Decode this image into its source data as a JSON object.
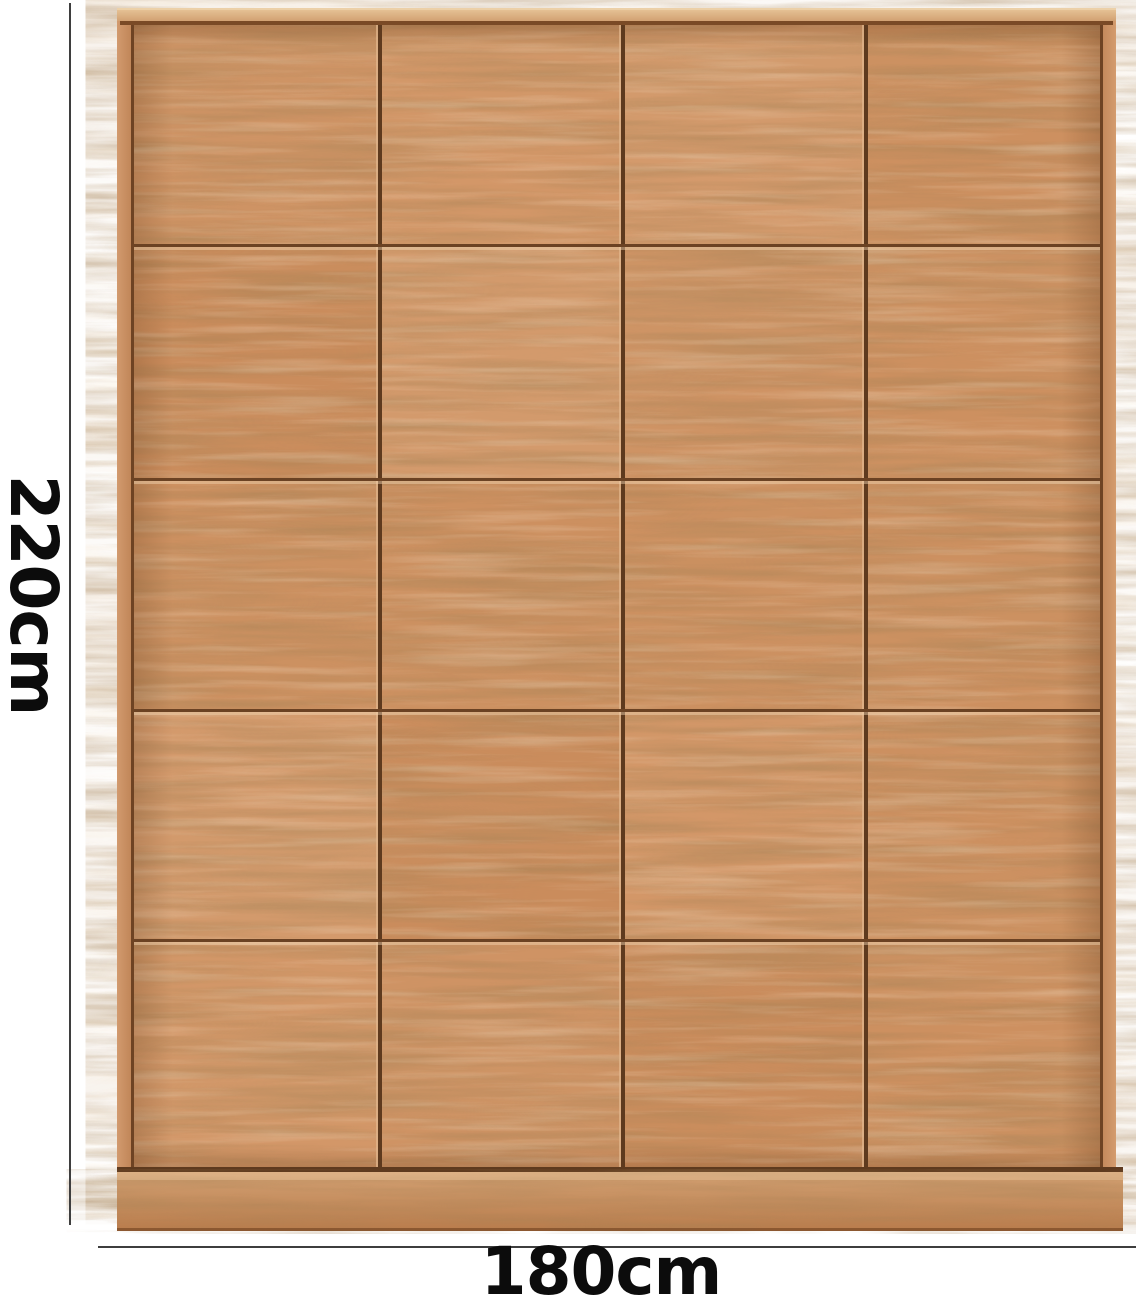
{
  "figure": {
    "type": "furniture-dimension-photo",
    "height_label": "220cm",
    "width_label": "180cm"
  },
  "wardrobe": {
    "description": "four-door natural wood wardrobe, front view",
    "door_columns": 4,
    "panel_rows": 5
  },
  "colors": {
    "wood_base": "#cf9364",
    "wood_light": "#dcab7e",
    "seam_dark": "#5e3a1e",
    "seam_row": "#6b4223",
    "plinth": "#c08254",
    "rim": "#d9a878",
    "dimension_line": "#3e3e3e",
    "label_text": "#0c0c0c",
    "background": "#ffffff"
  }
}
